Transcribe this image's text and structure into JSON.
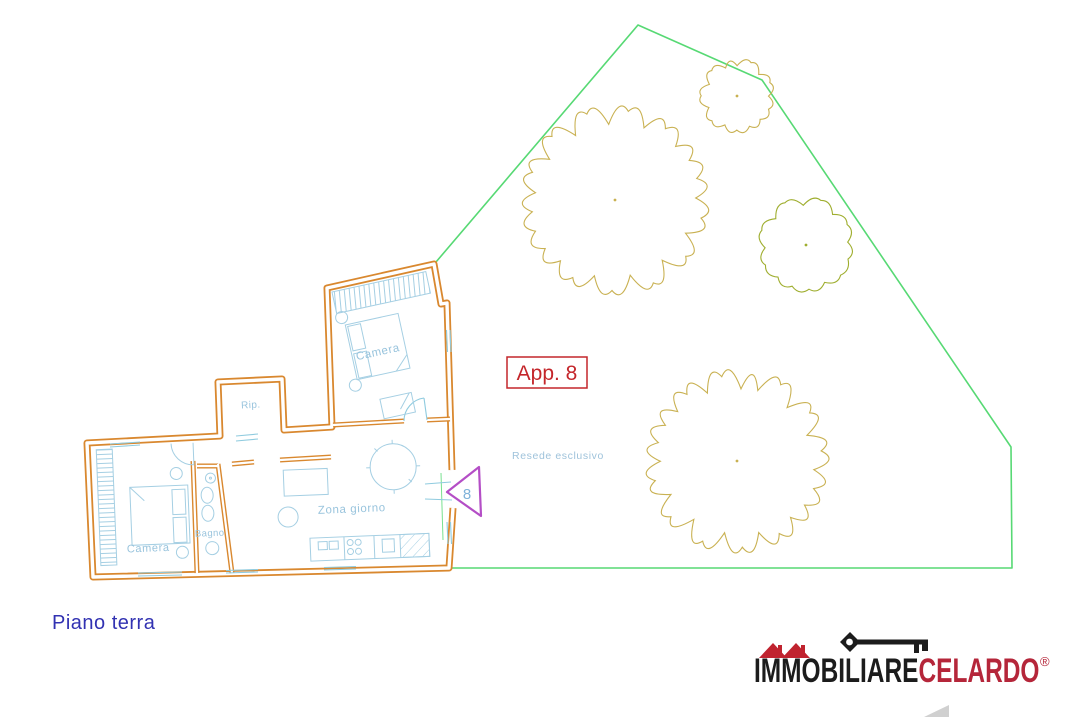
{
  "title_badge": {
    "label": "App. 8"
  },
  "floor_label": {
    "label": "Piano terra"
  },
  "garden": {
    "label": "Resede esclusivo"
  },
  "entrance": {
    "number": "8"
  },
  "rooms": [
    {
      "id": "camera-upper",
      "label": "Camera"
    },
    {
      "id": "rip",
      "label": "Rip."
    },
    {
      "id": "camera-lower",
      "label": "Camera"
    },
    {
      "id": "bagno",
      "label": "Bagno"
    },
    {
      "id": "zona-giorno",
      "label": "Zona giorno"
    }
  ],
  "logo": {
    "part1": "IMMOBILIARE",
    "part2": "CELARDO",
    "registered": "®"
  },
  "colors": {
    "wall_orange": "#d9882f",
    "furniture_blue": "#a5cfe3",
    "opening_cyan": "#8fcbdf",
    "room_label_blue": "#99c4dd",
    "garden_label_blue": "#9fc3db",
    "floor_label_blue": "#3232b2",
    "badge_red": "#c4262b",
    "entrance_triangle_purple": "#b44ec6",
    "entrance_number_blue": "#7fb2d9",
    "boundary_green": "#57d974",
    "tree_tan": "#c9b152",
    "tree_olive": "#9fae2f",
    "logo_black": "#1c1c1c",
    "logo_red": "#b5263a",
    "roof_red": "#c0232f",
    "north_arrow_gray": "#a9a9a9"
  },
  "diagram": {
    "garden_boundary": {
      "points": [
        [
          436,
          262
        ],
        [
          638,
          25
        ],
        [
          762,
          80
        ],
        [
          1011,
          447
        ],
        [
          1012,
          568
        ],
        [
          449,
          568
        ]
      ],
      "color": "#57d974"
    },
    "trees": [
      {
        "name": "large-tree-top",
        "cx": 615,
        "cy": 200,
        "r": 93,
        "color": "#c9b152",
        "seed": 3
      },
      {
        "name": "small-tree-top-right",
        "cx": 737,
        "cy": 96,
        "r": 37,
        "color": "#c9b152",
        "seed": 11
      },
      {
        "name": "green-tree-right",
        "cx": 806,
        "cy": 245,
        "r": 46,
        "color": "#9fae2f",
        "seed": 7
      },
      {
        "name": "large-tree-bottom",
        "cx": 737,
        "cy": 461,
        "r": 92,
        "color": "#c9b152",
        "seed": 5
      }
    ]
  }
}
